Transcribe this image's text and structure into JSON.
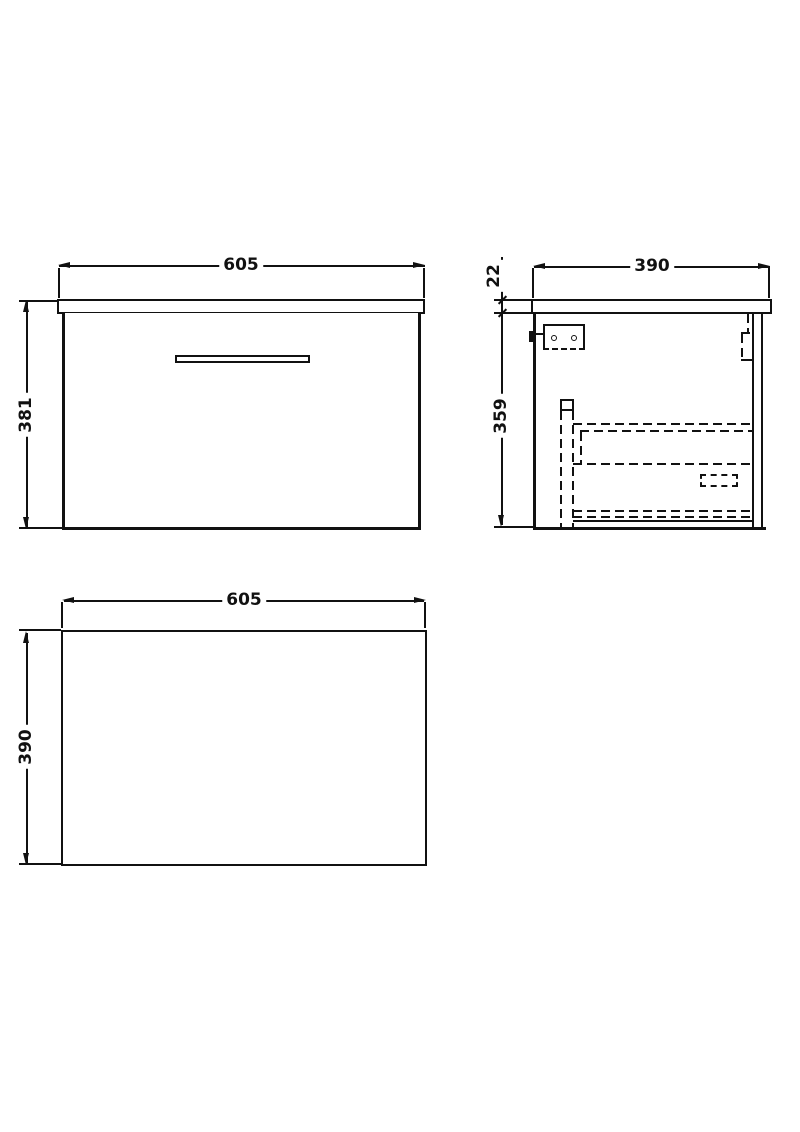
{
  "drawing": {
    "type": "orthographic technical drawing of wall-hung vanity drawer unit",
    "colors": {
      "ink": "#111111",
      "paper": "#ffffff"
    },
    "front": {
      "width": "605",
      "height": "381"
    },
    "side": {
      "depth": "390",
      "top_thickness": "22",
      "body_height": "359"
    },
    "plan": {
      "width": "605",
      "depth": "390"
    }
  }
}
